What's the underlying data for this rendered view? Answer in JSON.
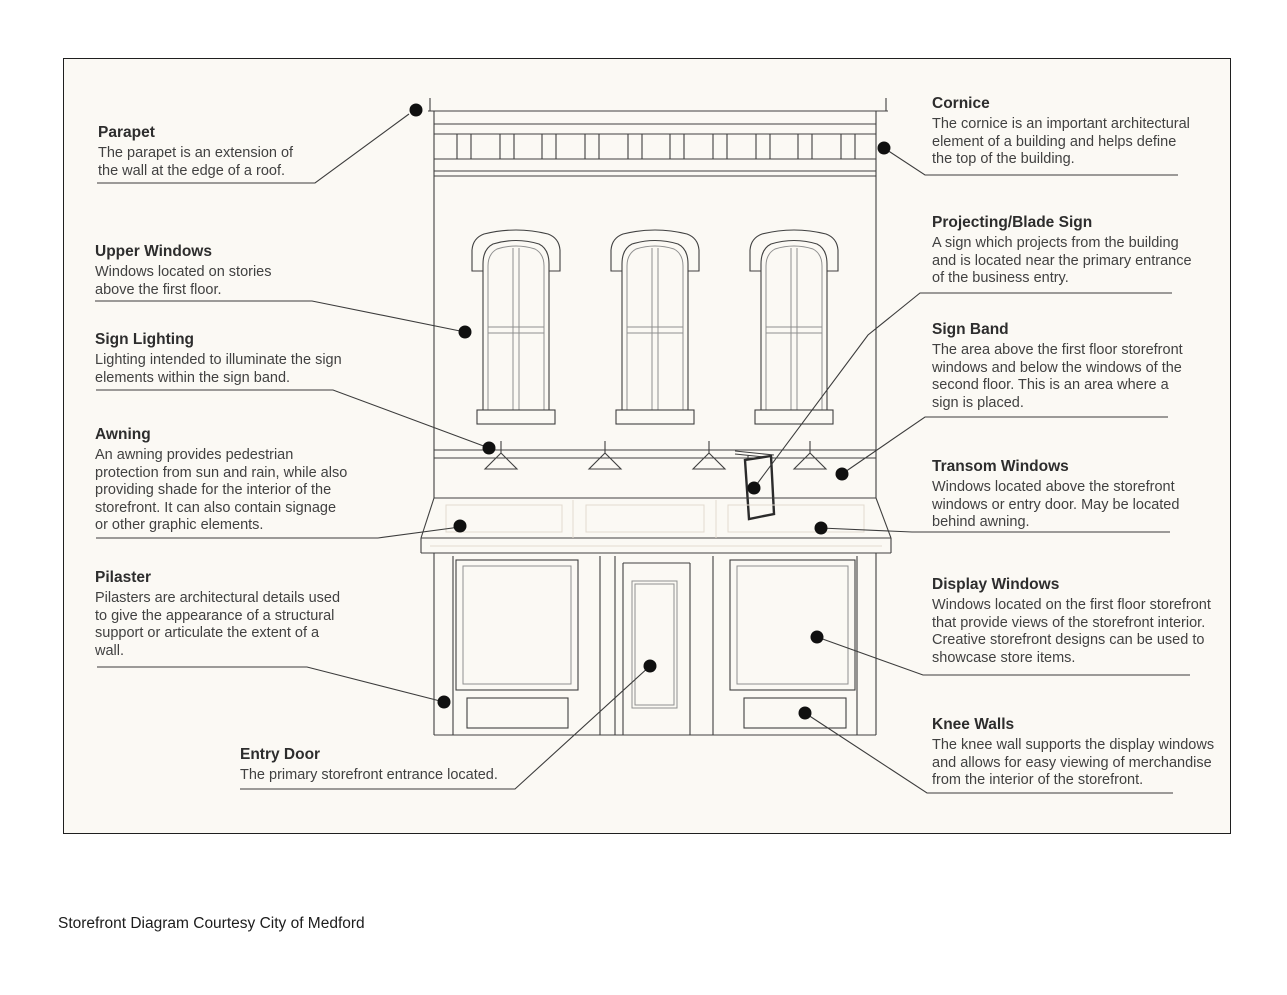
{
  "figure": {
    "caption": "Storefront Diagram Courtesy City of Medford"
  },
  "colors": {
    "paper": "#fbf9f4",
    "line": "#404040",
    "text": "#414141",
    "dot": "#101010"
  },
  "labels": {
    "parapet": {
      "title": "Parapet",
      "body": "The parapet is an extension of the wall at the edge of a roof."
    },
    "upper_windows": {
      "title": "Upper Windows",
      "body": "Windows located on stories above the first floor."
    },
    "sign_lighting": {
      "title": "Sign Lighting",
      "body": "Lighting intended to illuminate the sign elements within the sign band."
    },
    "awning": {
      "title": "Awning",
      "body": "An awning provides pedestrian protection from sun and rain, while also providing shade for the interior of the storefront. It can also contain signage or other graphic elements."
    },
    "pilaster": {
      "title": "Pilaster",
      "body": "Pilasters are architectural details used to give the appearance of a structural support or articulate the extent of a wall."
    },
    "entry_door": {
      "title": "Entry Door",
      "body": "The primary storefront entrance located."
    },
    "cornice": {
      "title": "Cornice",
      "body": "The cornice is an important architectural element of a building and helps define the top of the building."
    },
    "projecting_blade_sign": {
      "title": "Projecting/Blade Sign",
      "body": "A sign which projects from the building and is located near the primary entrance of the business entry."
    },
    "sign_band": {
      "title": "Sign Band",
      "body": "The area above the first floor storefront windows and below the windows of the second floor. This is an area where a sign is placed."
    },
    "transom_windows": {
      "title": "Transom Windows",
      "body": "Windows located above the storefront windows or entry door. May be located behind awning."
    },
    "display_windows": {
      "title": "Display Windows",
      "body": "Windows located on the first floor storefront that provide views of the storefront interior. Creative storefront designs can be used to showcase store items."
    },
    "knee_walls": {
      "title": "Knee Walls",
      "body": "The knee wall supports the display windows and allows for easy viewing of merchandise from the interior of the storefront."
    }
  }
}
